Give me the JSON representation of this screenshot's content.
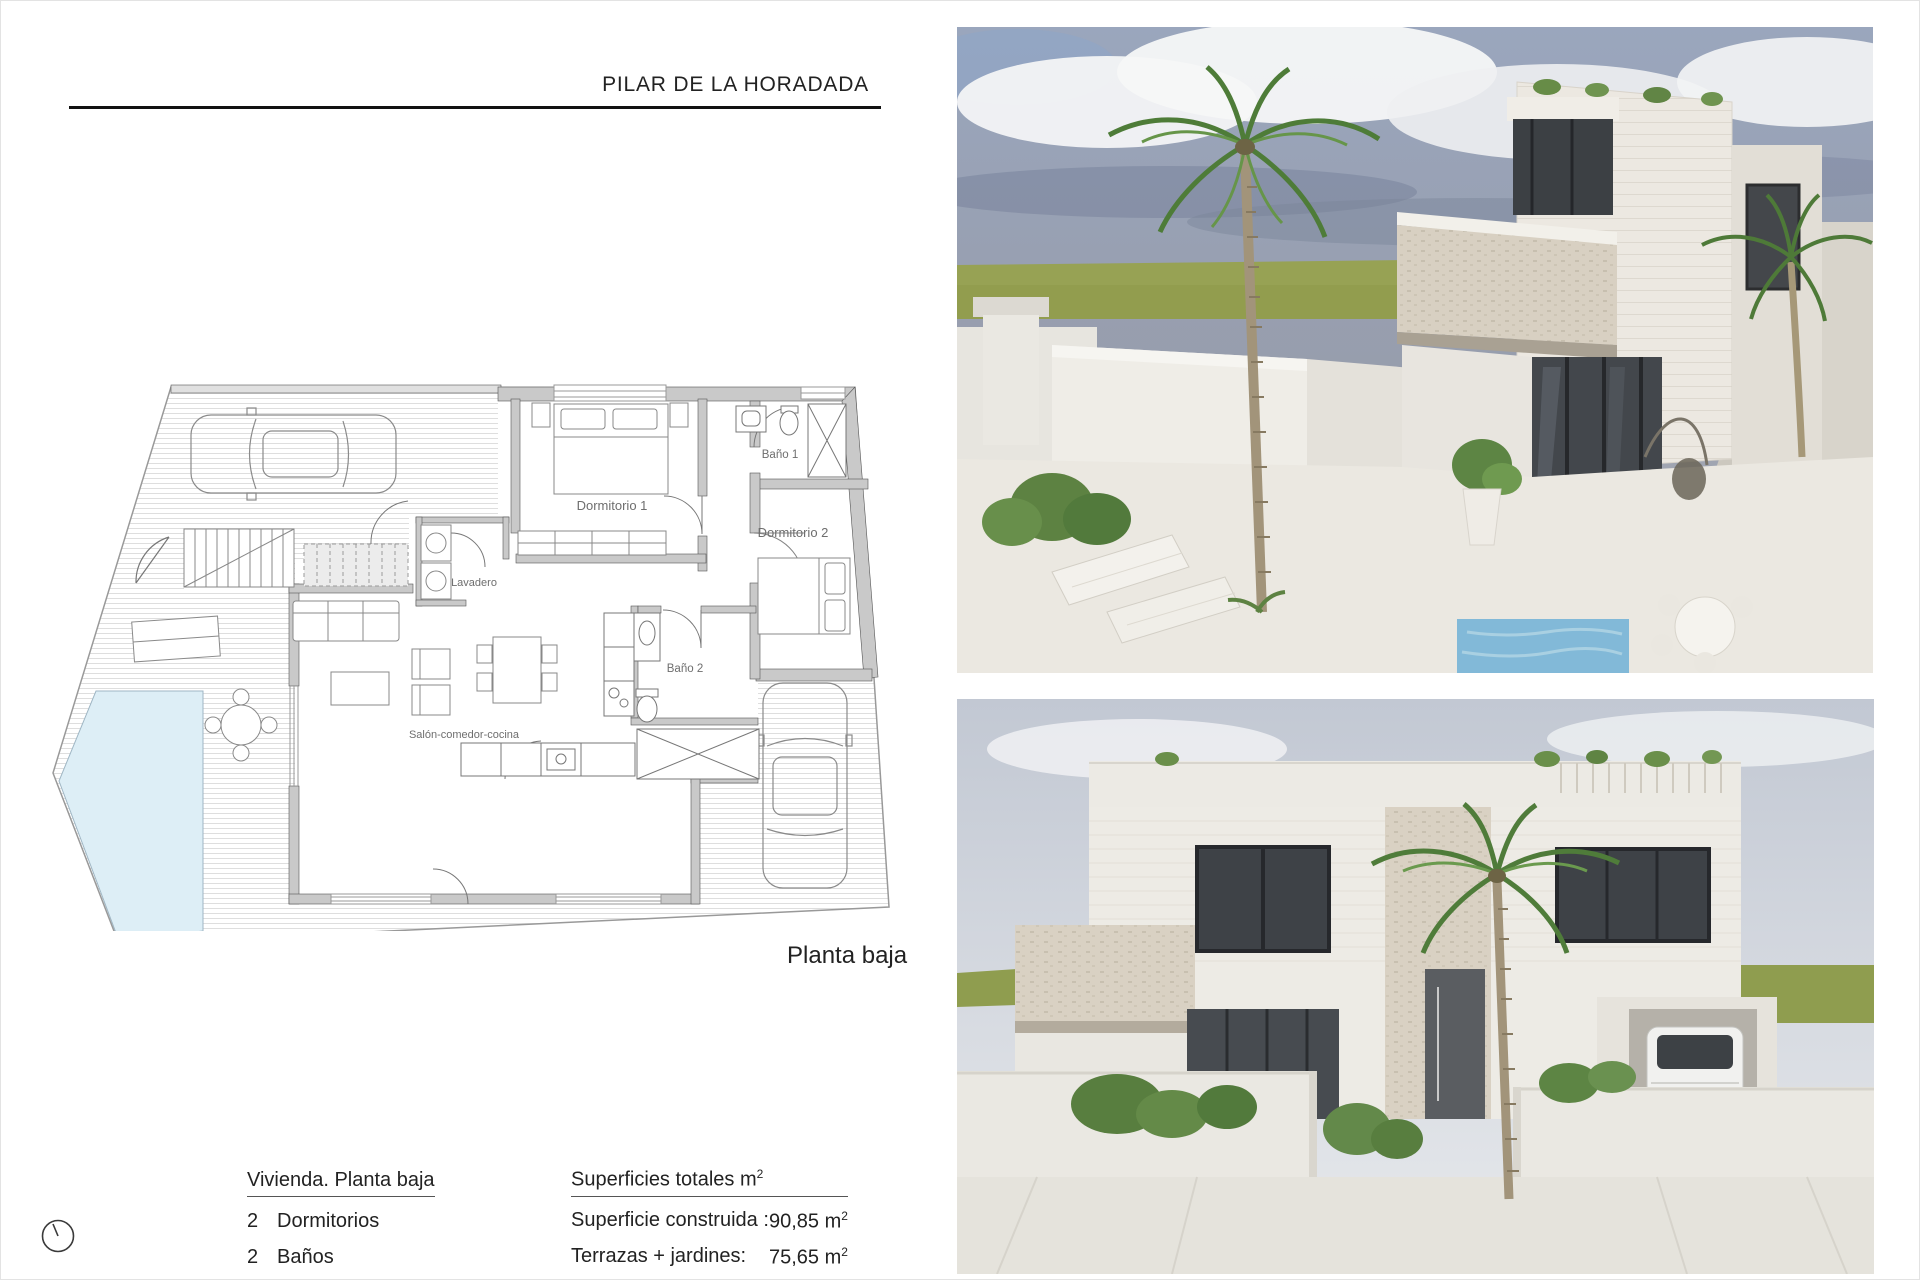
{
  "header": {
    "title": "PILAR DE LA HORADADA"
  },
  "plan": {
    "caption": "Planta baja",
    "room_labels": {
      "dormitorio1": "Dormitorio 1",
      "bano1": "Baño 1",
      "dormitorio2": "Dormitorio 2",
      "lavadero": "Lavadero",
      "bano2": "Baño 2",
      "salon": "Salón-comedor-cocina"
    }
  },
  "details": {
    "heading": "Vivienda. Planta baja",
    "bedrooms_count": "2",
    "bedrooms_label": "Dormitorios",
    "bathrooms_count": "2",
    "bathrooms_label": "Baños"
  },
  "surfaces": {
    "heading": "Superficies totales m",
    "heading_superscript": "2",
    "built_label": "Superficie construida :",
    "built_value": "90,85 m",
    "built_superscript": "2",
    "terraces_label": "Terrazas + jardines:",
    "terraces_value": "75,65 m",
    "terraces_superscript": "2"
  },
  "colors": {
    "text": "#1d1d1d",
    "rule": "#111111",
    "plan_wall": "#c9c9c9",
    "pool": "#ddeef6",
    "sky_top": "#9aa6bd",
    "grass": "#97a254",
    "stone": "#d8d0c2"
  }
}
